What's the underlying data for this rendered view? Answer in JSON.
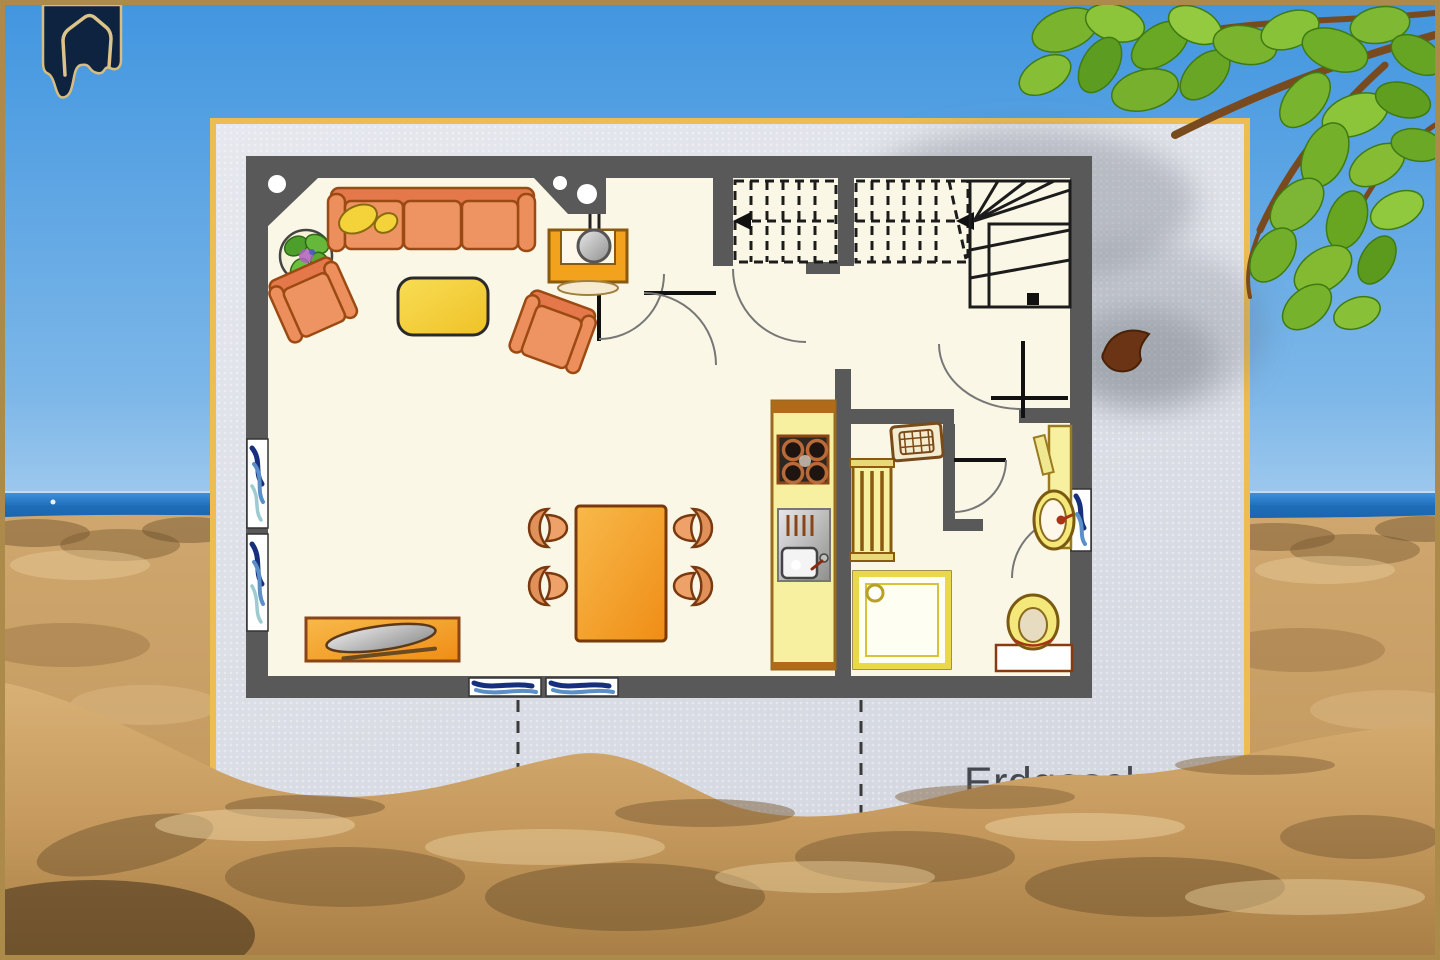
{
  "content": {
    "floor_label": "Erdgeschoss"
  },
  "logo": {
    "name": "gable-house-banner-logo"
  },
  "plan": {
    "furniture_icons": [
      "potted-plant",
      "three-seat-sofa",
      "armchair",
      "armchair",
      "coffee-table",
      "tv-lowboard",
      "dining-table",
      "dining-chair",
      "sideboard",
      "kitchen-counter",
      "stove-4-burners",
      "kitchen-sink",
      "radiator",
      "washing-machine",
      "shower",
      "washbasin",
      "toilet",
      "window",
      "staircase-dashed-flight",
      "staircase-winder",
      "door-swing-arc"
    ],
    "stair_arrows": "pointing-left",
    "section_lines": 2
  },
  "colors": {
    "frame_border": "#ab8a4a",
    "sky_top": "#4296e0",
    "sky_horizon": "#a6cdef",
    "sea_blue": "#1e6cb8",
    "sand_base": "#c9a068",
    "sand_shadow": "#6e4f2a",
    "sand_highlight": "#e8cd9c",
    "card_background": "#dde0e8",
    "card_border": "#edbc52",
    "wall_gray": "#595959",
    "floor_cream": "#fbf7e6",
    "furniture_salmon": "#ec8f5c",
    "furniture_outline_brown": "#8a4516",
    "coffee_table_yellow": "#f6d13c",
    "dining_table_orange": "#f49f2e",
    "kitchen_pale_yellow": "#f7f0a0",
    "window_navy": "#16307e",
    "window_light_blue": "#5b8fc8",
    "leaf_green": "#76b32a",
    "branch_brown": "#7a4a1f",
    "logo_navy": "#0d2340",
    "logo_gold": "#dcc389",
    "label_gray": "#45484e",
    "stair_line_black": "#1c1c1c"
  }
}
